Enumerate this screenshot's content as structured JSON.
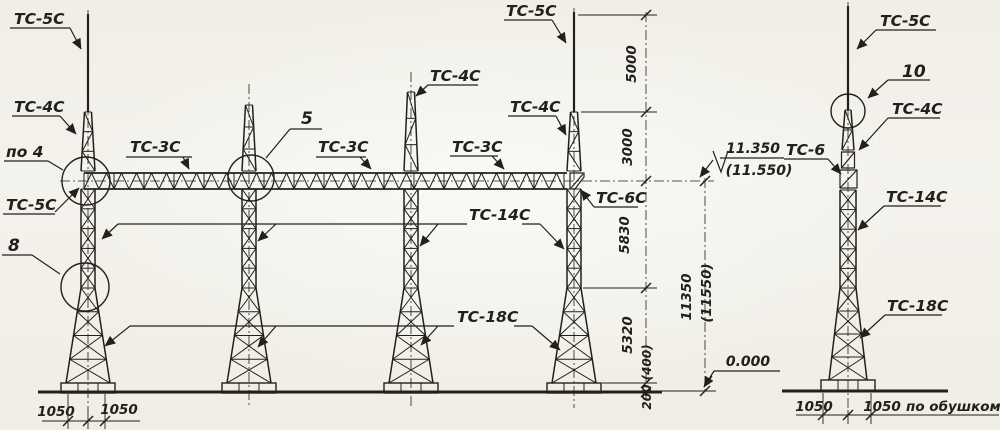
{
  "drawing": {
    "paper_color": "#f3f1ea",
    "ink_color": "#22201b",
    "labels": {
      "t1_rod": "ТС-5С",
      "t1_top": "ТС-4С",
      "node4": "по 4",
      "t1_rod_low": "ТС-5С",
      "node8": "8",
      "beam1": "ТС-3С",
      "node5": "5",
      "beam2": "ТС-3С",
      "t3_top": "ТС-4С",
      "t4_rod": "ТС-5С",
      "t4_top": "ТС-4С",
      "beam3": "ТС-3С",
      "beam_support": "ТС-6С",
      "mid_section": "ТС-14С",
      "base_section": "ТС-18С",
      "r_rod": "ТС-5С",
      "node10": "10",
      "r_top": "ТС-4С",
      "r_insert": "ТС-6",
      "r_mid": "ТС-14С",
      "r_base": "ТС-18С"
    },
    "dims": {
      "d5000": "5000",
      "d3000": "3000",
      "d5830": "5830",
      "d5320": "5320",
      "d200": "200 (400)",
      "total": "11350",
      "total_alt": "(11550)",
      "bl1": "1050",
      "bl2": "1050",
      "br1": "1050",
      "br2": "1050",
      "note": "по обушком"
    },
    "elev": {
      "top": "11.350",
      "top_alt": "(11.550)",
      "zero": "0.000"
    }
  }
}
